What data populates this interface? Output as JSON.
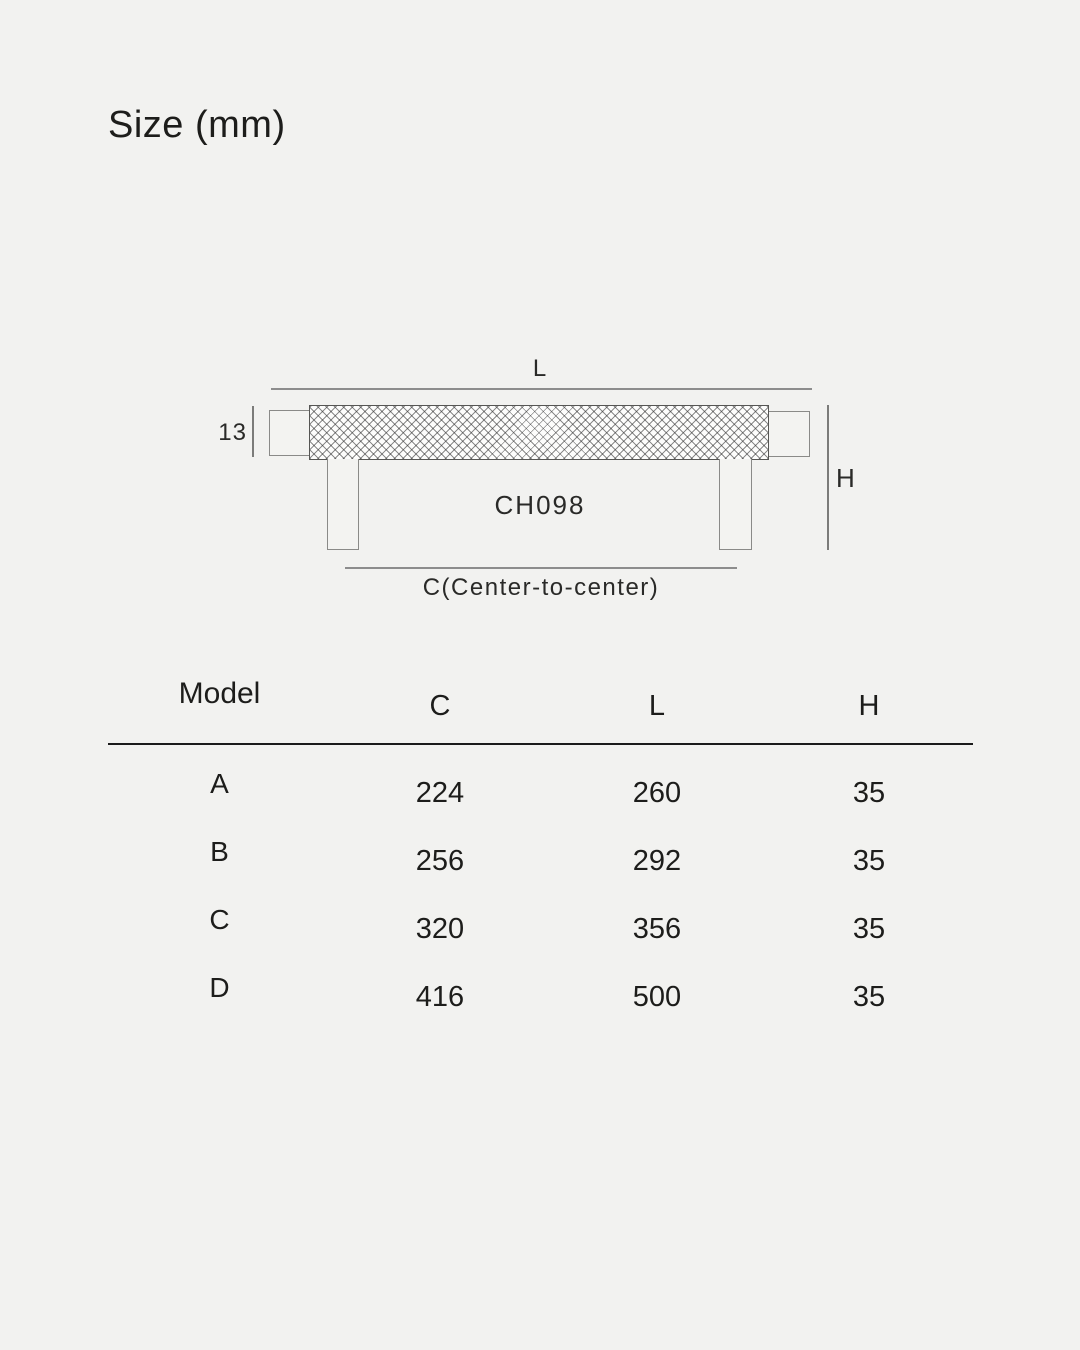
{
  "page": {
    "title": "Size (mm)",
    "background_color": "#f2f2f0",
    "text_color": "#1d1d1b"
  },
  "diagram": {
    "product_code": "CH098",
    "length_label": "L",
    "height_label": "H",
    "thickness_label": "13",
    "center_label": "C(Center-to-center)",
    "dimension_line_color": "#8d8d8d"
  },
  "table": {
    "headers": {
      "model": "Model",
      "c": "C",
      "l": "L",
      "h": "H"
    },
    "rows": [
      {
        "model": "A",
        "c": "224",
        "l": "260",
        "h": "35"
      },
      {
        "model": "B",
        "c": "256",
        "l": "292",
        "h": "35"
      },
      {
        "model": "C",
        "c": "320",
        "l": "356",
        "h": "35"
      },
      {
        "model": "D",
        "c": "416",
        "l": "500",
        "h": "35"
      }
    ]
  }
}
